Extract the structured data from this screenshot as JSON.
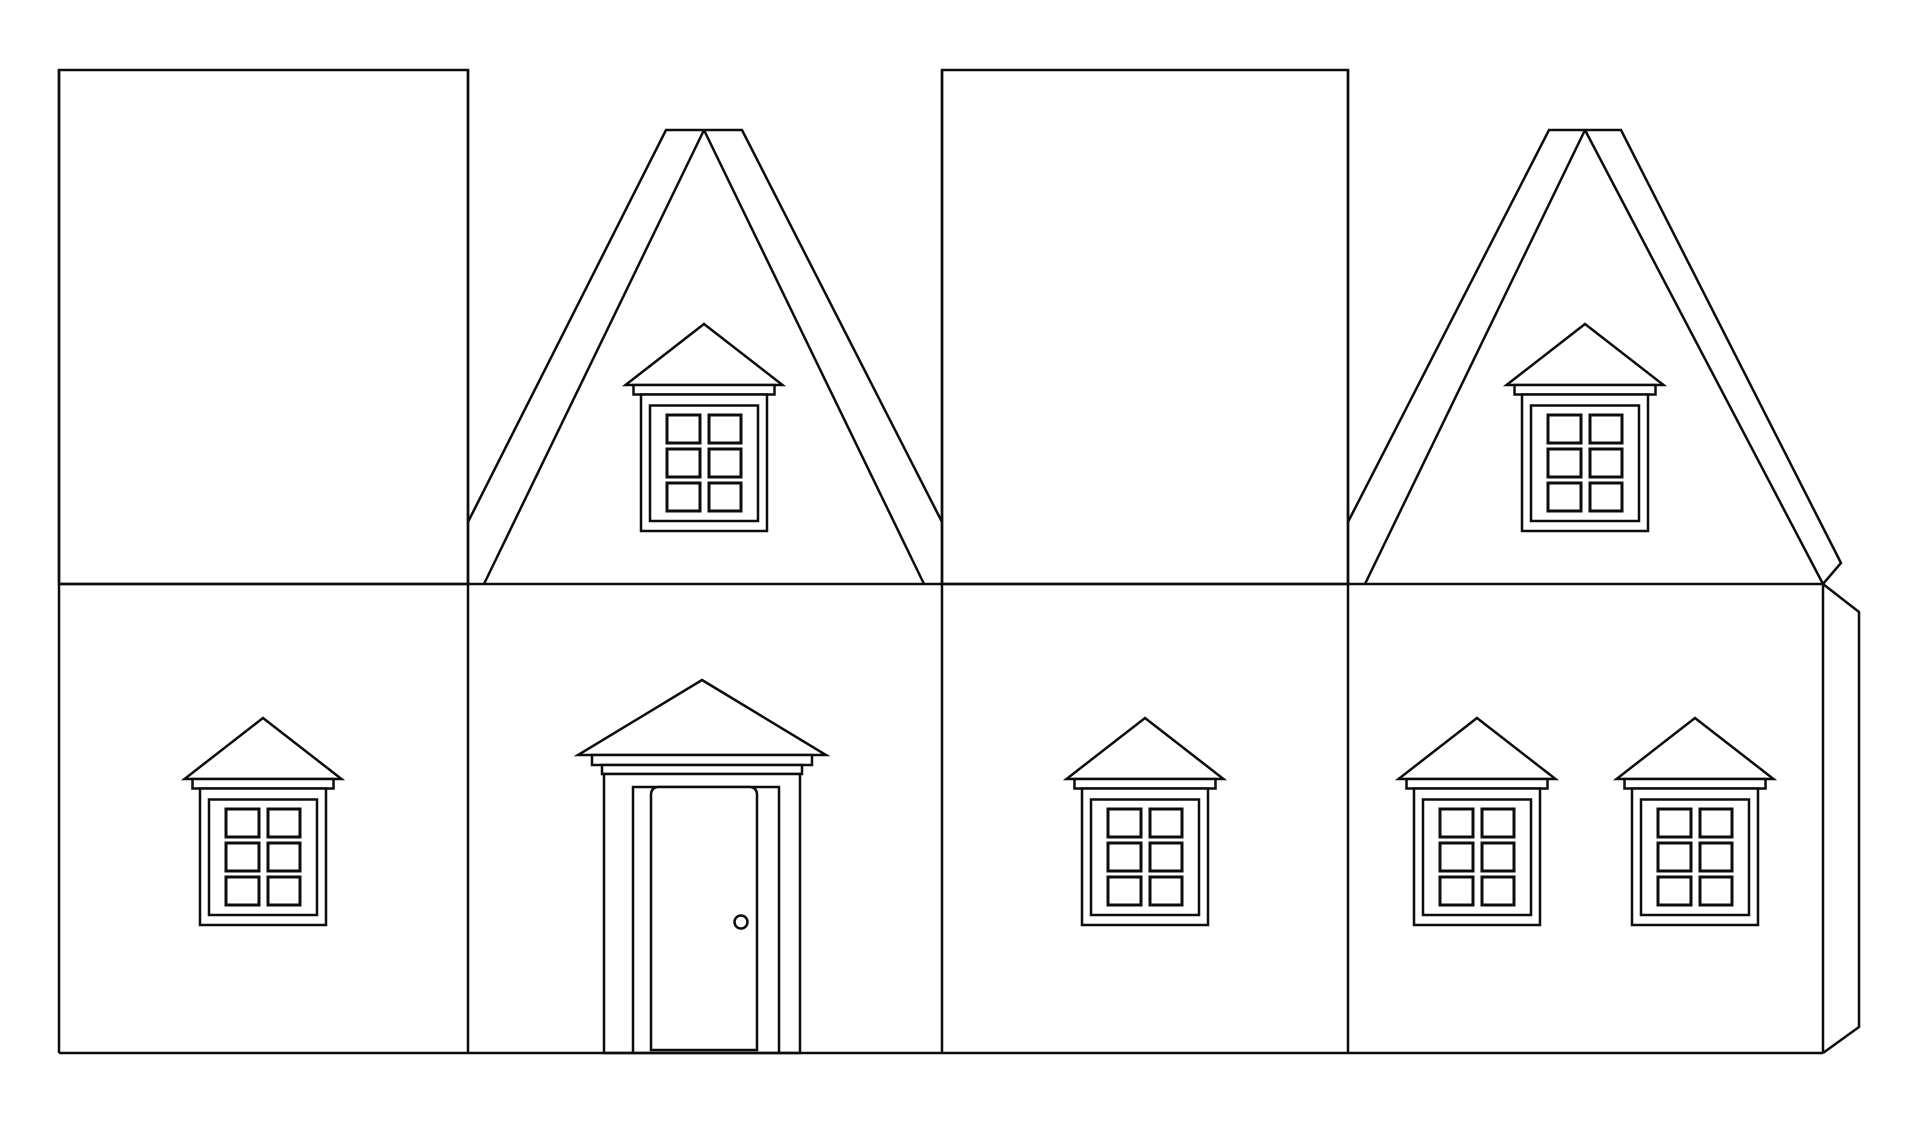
{
  "palette": {
    "background": "#ffffff",
    "stroke": "#0d0d0d",
    "panel_fill": "#ffffff"
  },
  "scene": {
    "kind": "paper-house-cutout-template",
    "style": "black-and-white line art, uncolored printable",
    "panel_count": 4,
    "glue_tab_count": 1
  },
  "shingle_panels": {
    "count": 2,
    "pattern": "fish-scale-shingles",
    "scale_width_px": 45,
    "row_drop_px": 40,
    "columns_per_panel": 9,
    "rows_per_panel": 13
  },
  "gable_ends": {
    "count": 2,
    "ridge_style": "flat-topped double barge board",
    "attic_windows": 2
  },
  "windows": {
    "total": 6,
    "attic": 2,
    "wall": 4,
    "style": {
      "pediment_roof": true,
      "cornice_board": true,
      "double_frame": true,
      "pane_grid": "2x3",
      "panes_per_window": 6
    }
  },
  "door": {
    "count": 1,
    "porch_roof": true,
    "cornice_boards": 2,
    "frame": "double post",
    "knob": true,
    "panel_top": "rounded corners"
  },
  "fold_lines": {
    "vertical_panel_folds": 3,
    "eave_fold": 1,
    "base_line": 1
  }
}
